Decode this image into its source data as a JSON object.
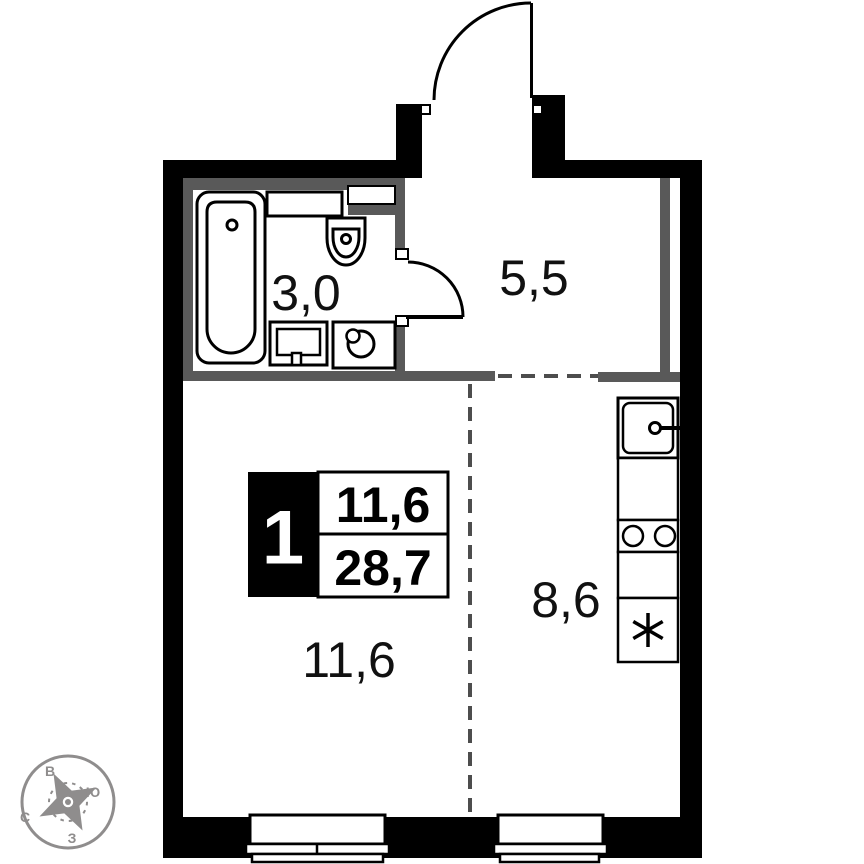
{
  "badge": {
    "rooms_count": "1",
    "living_area": "11,6",
    "total_area": "28,7"
  },
  "rooms": [
    {
      "id": "bathroom",
      "area": "3,0"
    },
    {
      "id": "hallway",
      "area": "5,5"
    },
    {
      "id": "kitchen",
      "area": "8,6"
    },
    {
      "id": "living_room",
      "area": "11,6"
    }
  ],
  "compass": {
    "east": "В",
    "south": "Ю",
    "north": "С",
    "west": "З"
  },
  "fixtures": {
    "bathroom": [
      "bathtub",
      "shelf",
      "wash-basin",
      "vanity-cabinet",
      "washing-machine"
    ],
    "kitchen": [
      "kitchen-sink",
      "counter",
      "cooktop-two-burners",
      "counter",
      "refrigerator"
    ]
  },
  "colors": {
    "wall": "#000000",
    "partition": "#595959",
    "dashed_line": "#4d4d4d",
    "compass": "#8f8d8d",
    "background": "#ffffff",
    "text": "#111111"
  }
}
